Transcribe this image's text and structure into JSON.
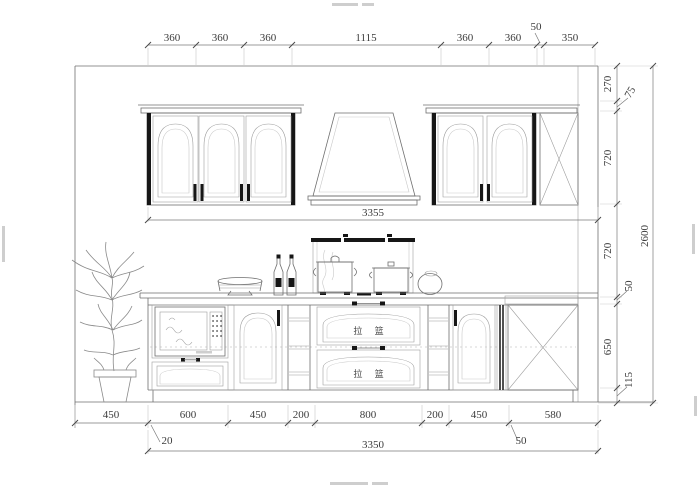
{
  "dims": {
    "top": [
      "360",
      "360",
      "360",
      "1115",
      "360",
      "360",
      "50",
      "350"
    ],
    "upper_width": "3355",
    "right": [
      "270",
      "75",
      "720",
      "720",
      "50",
      "650",
      "115"
    ],
    "right_total": "2600",
    "bottom": [
      "450",
      "600",
      "450",
      "200",
      "800",
      "200",
      "450",
      "580"
    ],
    "bottom_offsets": {
      "left": "20",
      "total": "3350",
      "right": "50"
    }
  },
  "labels": {
    "drawer_basket_top": "拉 篮",
    "drawer_basket_bottom": "拉 篮"
  },
  "colors": {
    "background": "#ffffff",
    "linework": "#6f6f6f",
    "dark_fill": "#161616",
    "dimension_text": "#3c3c3c"
  }
}
